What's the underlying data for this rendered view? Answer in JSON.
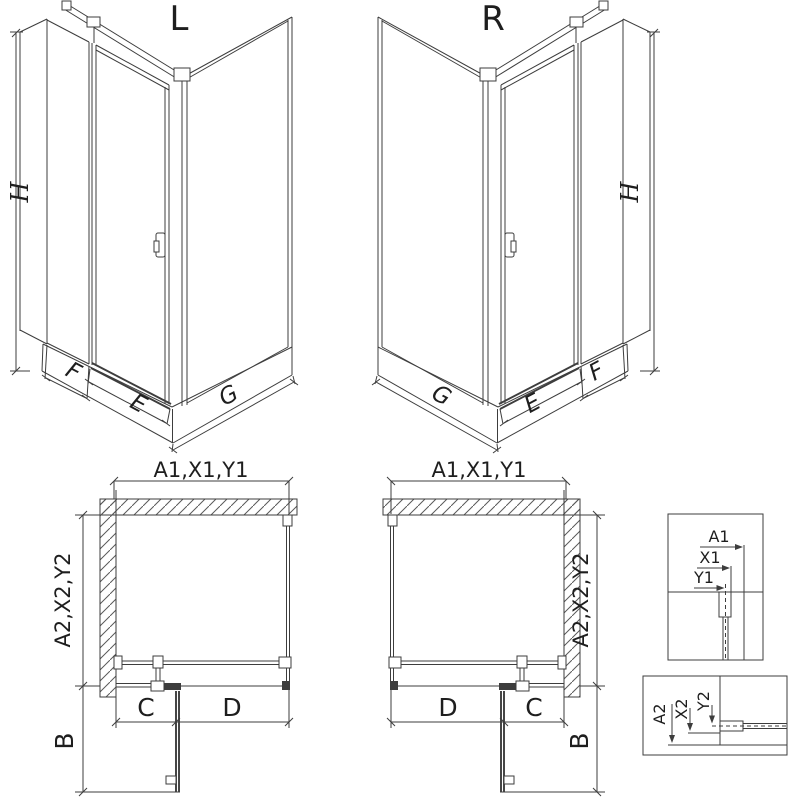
{
  "drawing": {
    "background": "#ffffff",
    "line_color": "#3d3d3d",
    "views": {
      "iso_left": {
        "label": "L"
      },
      "iso_right": {
        "label": "R"
      }
    },
    "dim_labels": {
      "h": "H",
      "f": "F",
      "e": "E",
      "g": "G",
      "a1x1y1": "A1,X1,Y1",
      "a2x2y2": "A2,X2,Y2",
      "b": "B",
      "c": "C",
      "d": "D"
    },
    "detail_labels": {
      "a1": "A1",
      "x1": "X1",
      "y1": "Y1",
      "a2": "A2",
      "x2": "X2",
      "y2": "Y2"
    }
  }
}
